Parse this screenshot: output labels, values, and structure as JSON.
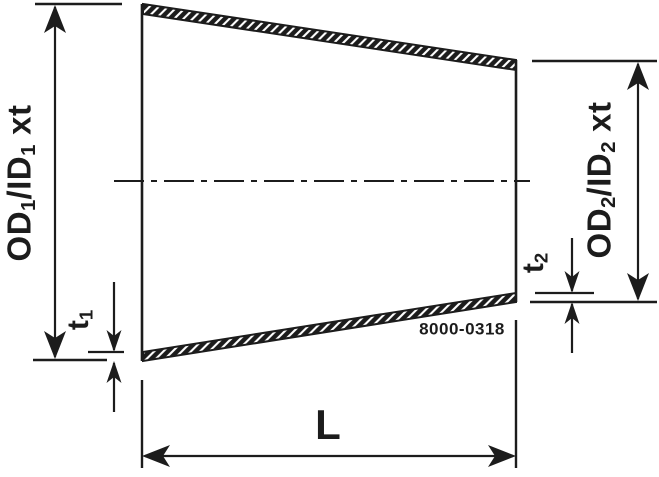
{
  "colors": {
    "ink": "#1c1c1c",
    "background": "#ffffff"
  },
  "drawing": {
    "dimensions": {
      "od1": {
        "segments": [
          {
            "text": "OD"
          },
          {
            "text": "1",
            "sub": true
          },
          {
            "text": "/ID"
          },
          {
            "text": "1",
            "sub": true
          },
          {
            "text": " xt"
          }
        ]
      },
      "t1": {
        "segments": [
          {
            "text": "t"
          },
          {
            "text": "1",
            "sub": true
          }
        ]
      },
      "od2": {
        "segments": [
          {
            "text": "OD"
          },
          {
            "text": "2",
            "sub": true
          },
          {
            "text": "/ID"
          },
          {
            "text": "2",
            "sub": true
          },
          {
            "text": " xt"
          }
        ]
      },
      "t2": {
        "segments": [
          {
            "text": "t"
          },
          {
            "text": "2",
            "sub": true
          }
        ]
      },
      "length": "L"
    },
    "part_number": "8000-0318"
  }
}
